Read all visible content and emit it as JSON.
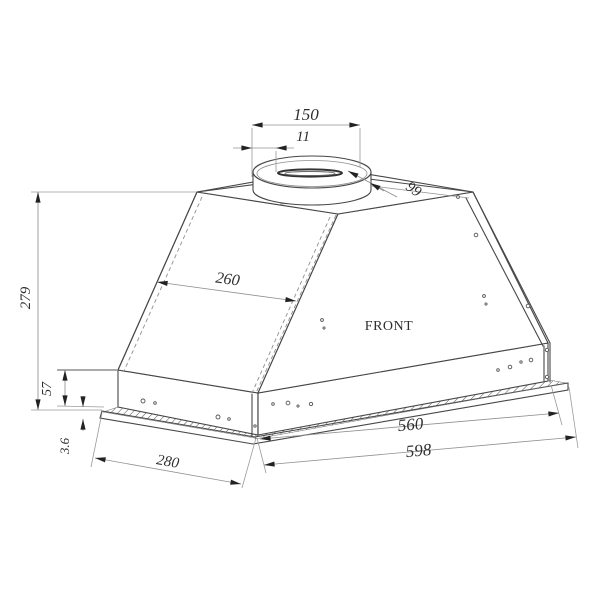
{
  "drawing": {
    "type": "range-hood-dimension-drawing",
    "background": "#ffffff",
    "line_color": "#474747",
    "dim_line_color": "#909090",
    "text_color": "#2f2f2f"
  },
  "labels": {
    "front": "FRONT"
  },
  "dims": {
    "d150": "150",
    "d11": "11",
    "d99": "99",
    "d279": "279",
    "d260": "260",
    "d57": "57",
    "d36": "3.6",
    "d280": "280",
    "d560": "560",
    "d598": "598"
  }
}
